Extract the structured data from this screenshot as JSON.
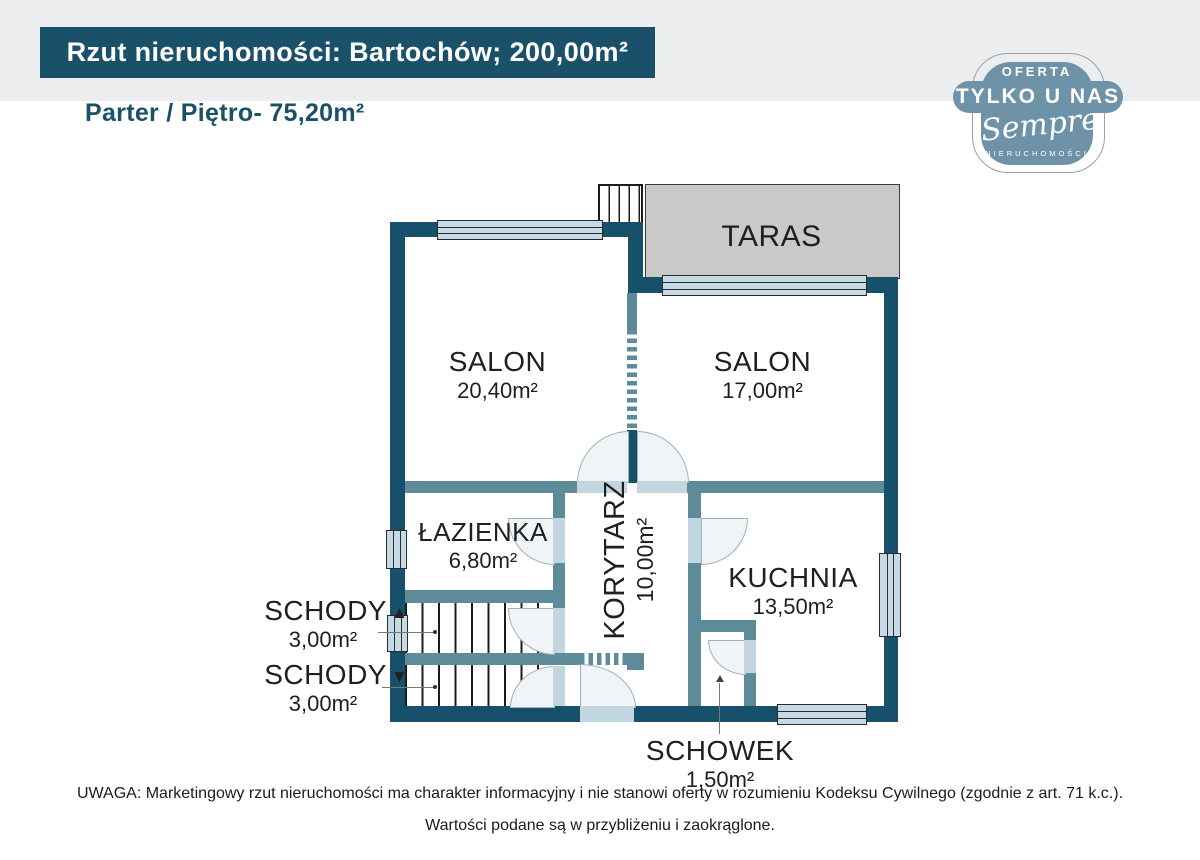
{
  "header": {
    "banner_title": "Rzut nieruchomości: Bartochów; 200,00m²",
    "floor_label": "Parter / Piętro- 75,20m²"
  },
  "badge": {
    "line1": "OFERTA",
    "line2": "TYLKO U NAS",
    "script": "Sempre",
    "line3": "NIERUCHOMOŚCI"
  },
  "plan": {
    "rooms": [
      {
        "id": "salon-left",
        "name": "SALON",
        "area": "20,40m²"
      },
      {
        "id": "salon-right",
        "name": "SALON",
        "area": "17,00m²"
      },
      {
        "id": "taras",
        "name": "TARAS",
        "area": ""
      },
      {
        "id": "lazienka",
        "name": "ŁAZIENKA",
        "area": "6,80m²"
      },
      {
        "id": "korytarz",
        "name": "KORYTARZ",
        "area": "10,00m²"
      },
      {
        "id": "kuchnia",
        "name": "KUCHNIA",
        "area": "13,50m²"
      },
      {
        "id": "schody-up",
        "name": "SCHODY",
        "area": "3,00m²",
        "arrow": "▲"
      },
      {
        "id": "schody-down",
        "name": "SCHODY",
        "area": "3,00m²",
        "arrow": "▼"
      },
      {
        "id": "schowek",
        "name": "SCHOWEK",
        "area": "1,50m²"
      }
    ]
  },
  "footer": {
    "line1": "UWAGA: Marketingowy rzut nieruchomości ma charakter informacyjny i nie stanowi oferty w rozumieniu Kodeksu Cywilnego (zgodnie z art. 71 k.c.).",
    "line2": "Wartości podane są w przybliżeniu i zaokrąglone."
  },
  "colors": {
    "accent_teal": "#1A5168",
    "wall_dark": "#17506A",
    "wall_light": "#5E8B9A",
    "window_fill": "#C5DAE4",
    "taras_gray": "#C9C9C9",
    "badge_blue": "#6E93A8",
    "band_gray": "#ECEDEE"
  }
}
